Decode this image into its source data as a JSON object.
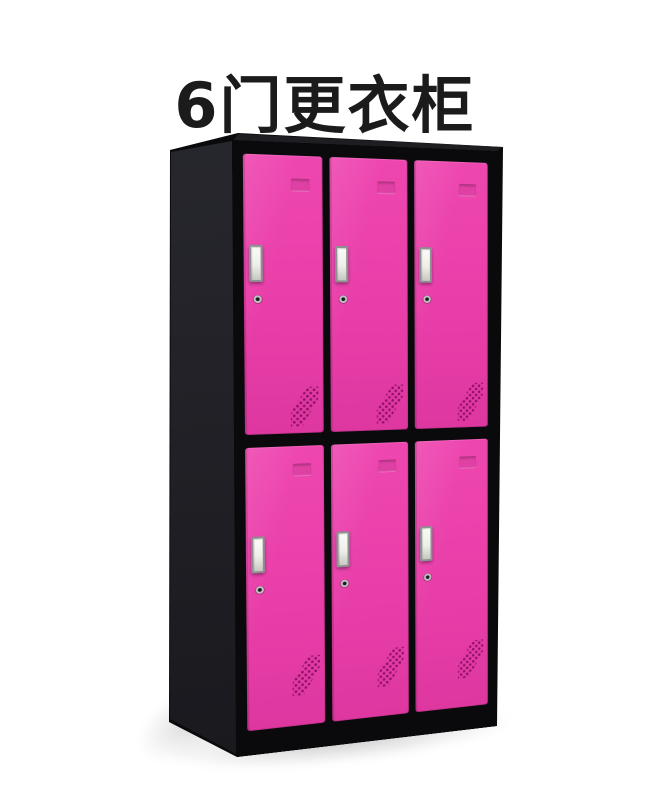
{
  "page": {
    "title": "6门更衣柜",
    "background": "#ffffff"
  },
  "cabinet": {
    "name": "6门更衣柜",
    "door_count": 6,
    "rows": 2,
    "columns": 3,
    "door_features": [
      "card-label-slot",
      "metal-handle",
      "keyhole-lock",
      "diagonal-air-vents"
    ]
  },
  "colors": {
    "background": "#ffffff",
    "title-text": "#1b1b1b",
    "frame-black": "#0a0a0d",
    "side-dark": "#2a2a31",
    "side-darker": "#17171c",
    "top-face": "#1d1d22",
    "door-pink": "#e93ea9",
    "door-pink-light": "#ee46af",
    "door-pink-dark": "#de37a0",
    "vent-dot": "#8c1063",
    "handle-border": "#8f9094"
  }
}
